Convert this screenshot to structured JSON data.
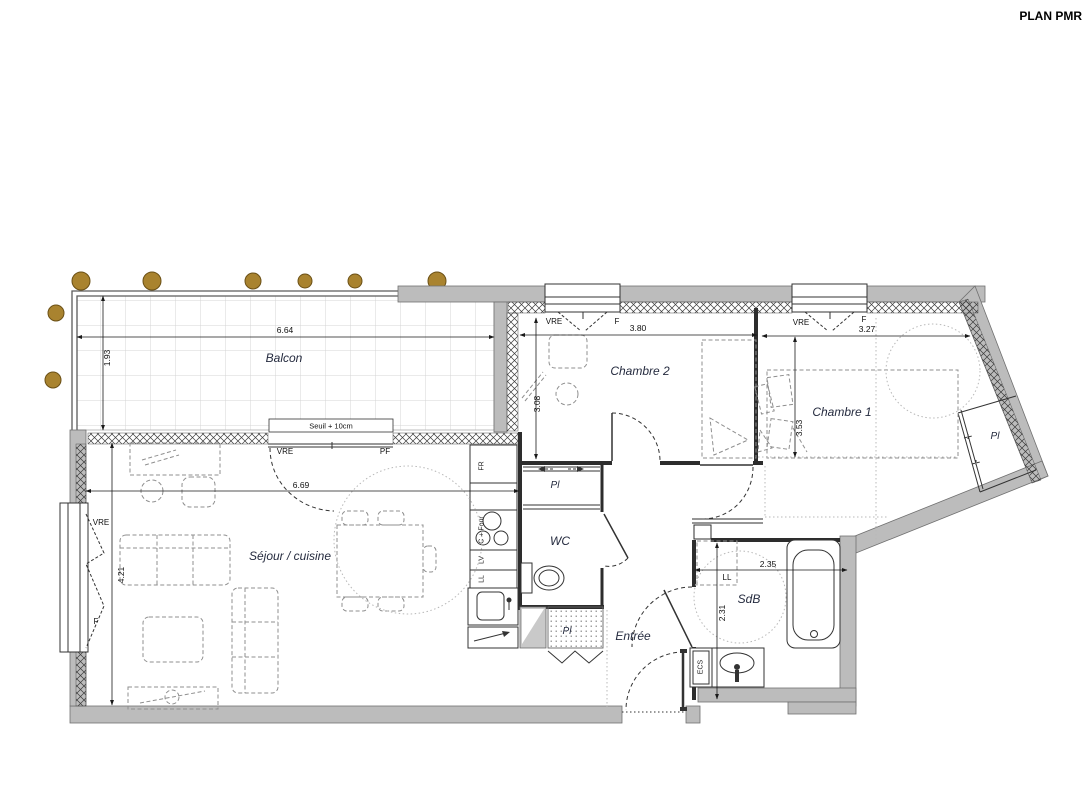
{
  "title": "PLAN PMR",
  "balcony": {
    "label": "Balcon",
    "width": "6.64",
    "depth": "1.93",
    "threshold": "Seuil + 10cm"
  },
  "chambre2": {
    "label": "Chambre 2",
    "width": "3.80",
    "depth": "3.08",
    "window": {
      "vre": "VRE",
      "f": "F"
    }
  },
  "chambre1": {
    "label": "Chambre 1",
    "width": "3.27",
    "depth": "3.53",
    "window": {
      "vre": "VRE",
      "f": "F"
    },
    "closet": "Pl"
  },
  "sejour": {
    "label": "Séjour / cuisine",
    "width": "6.69",
    "depth": "4.21",
    "bay": {
      "vre": "VRE",
      "pf": "PF"
    },
    "side_window": {
      "vre": "VRE",
      "f": "F"
    }
  },
  "kitchen": {
    "fridge": "FR",
    "cooktop_oven": "C + Four",
    "dishwasher": "LV",
    "washer": "LL"
  },
  "wc": {
    "label": "WC",
    "closet": "Pl"
  },
  "entree": {
    "label": "Entrée",
    "closet": "Pl"
  },
  "sdb": {
    "label": "SdB",
    "width": "2.35",
    "depth": "2.31",
    "washer": "LL",
    "water_heater": "ECS"
  },
  "colors": {
    "wall": "#bcbcbc",
    "post": "#a9832f",
    "line": "#2d2d2d",
    "room_label": "#252b3f"
  }
}
